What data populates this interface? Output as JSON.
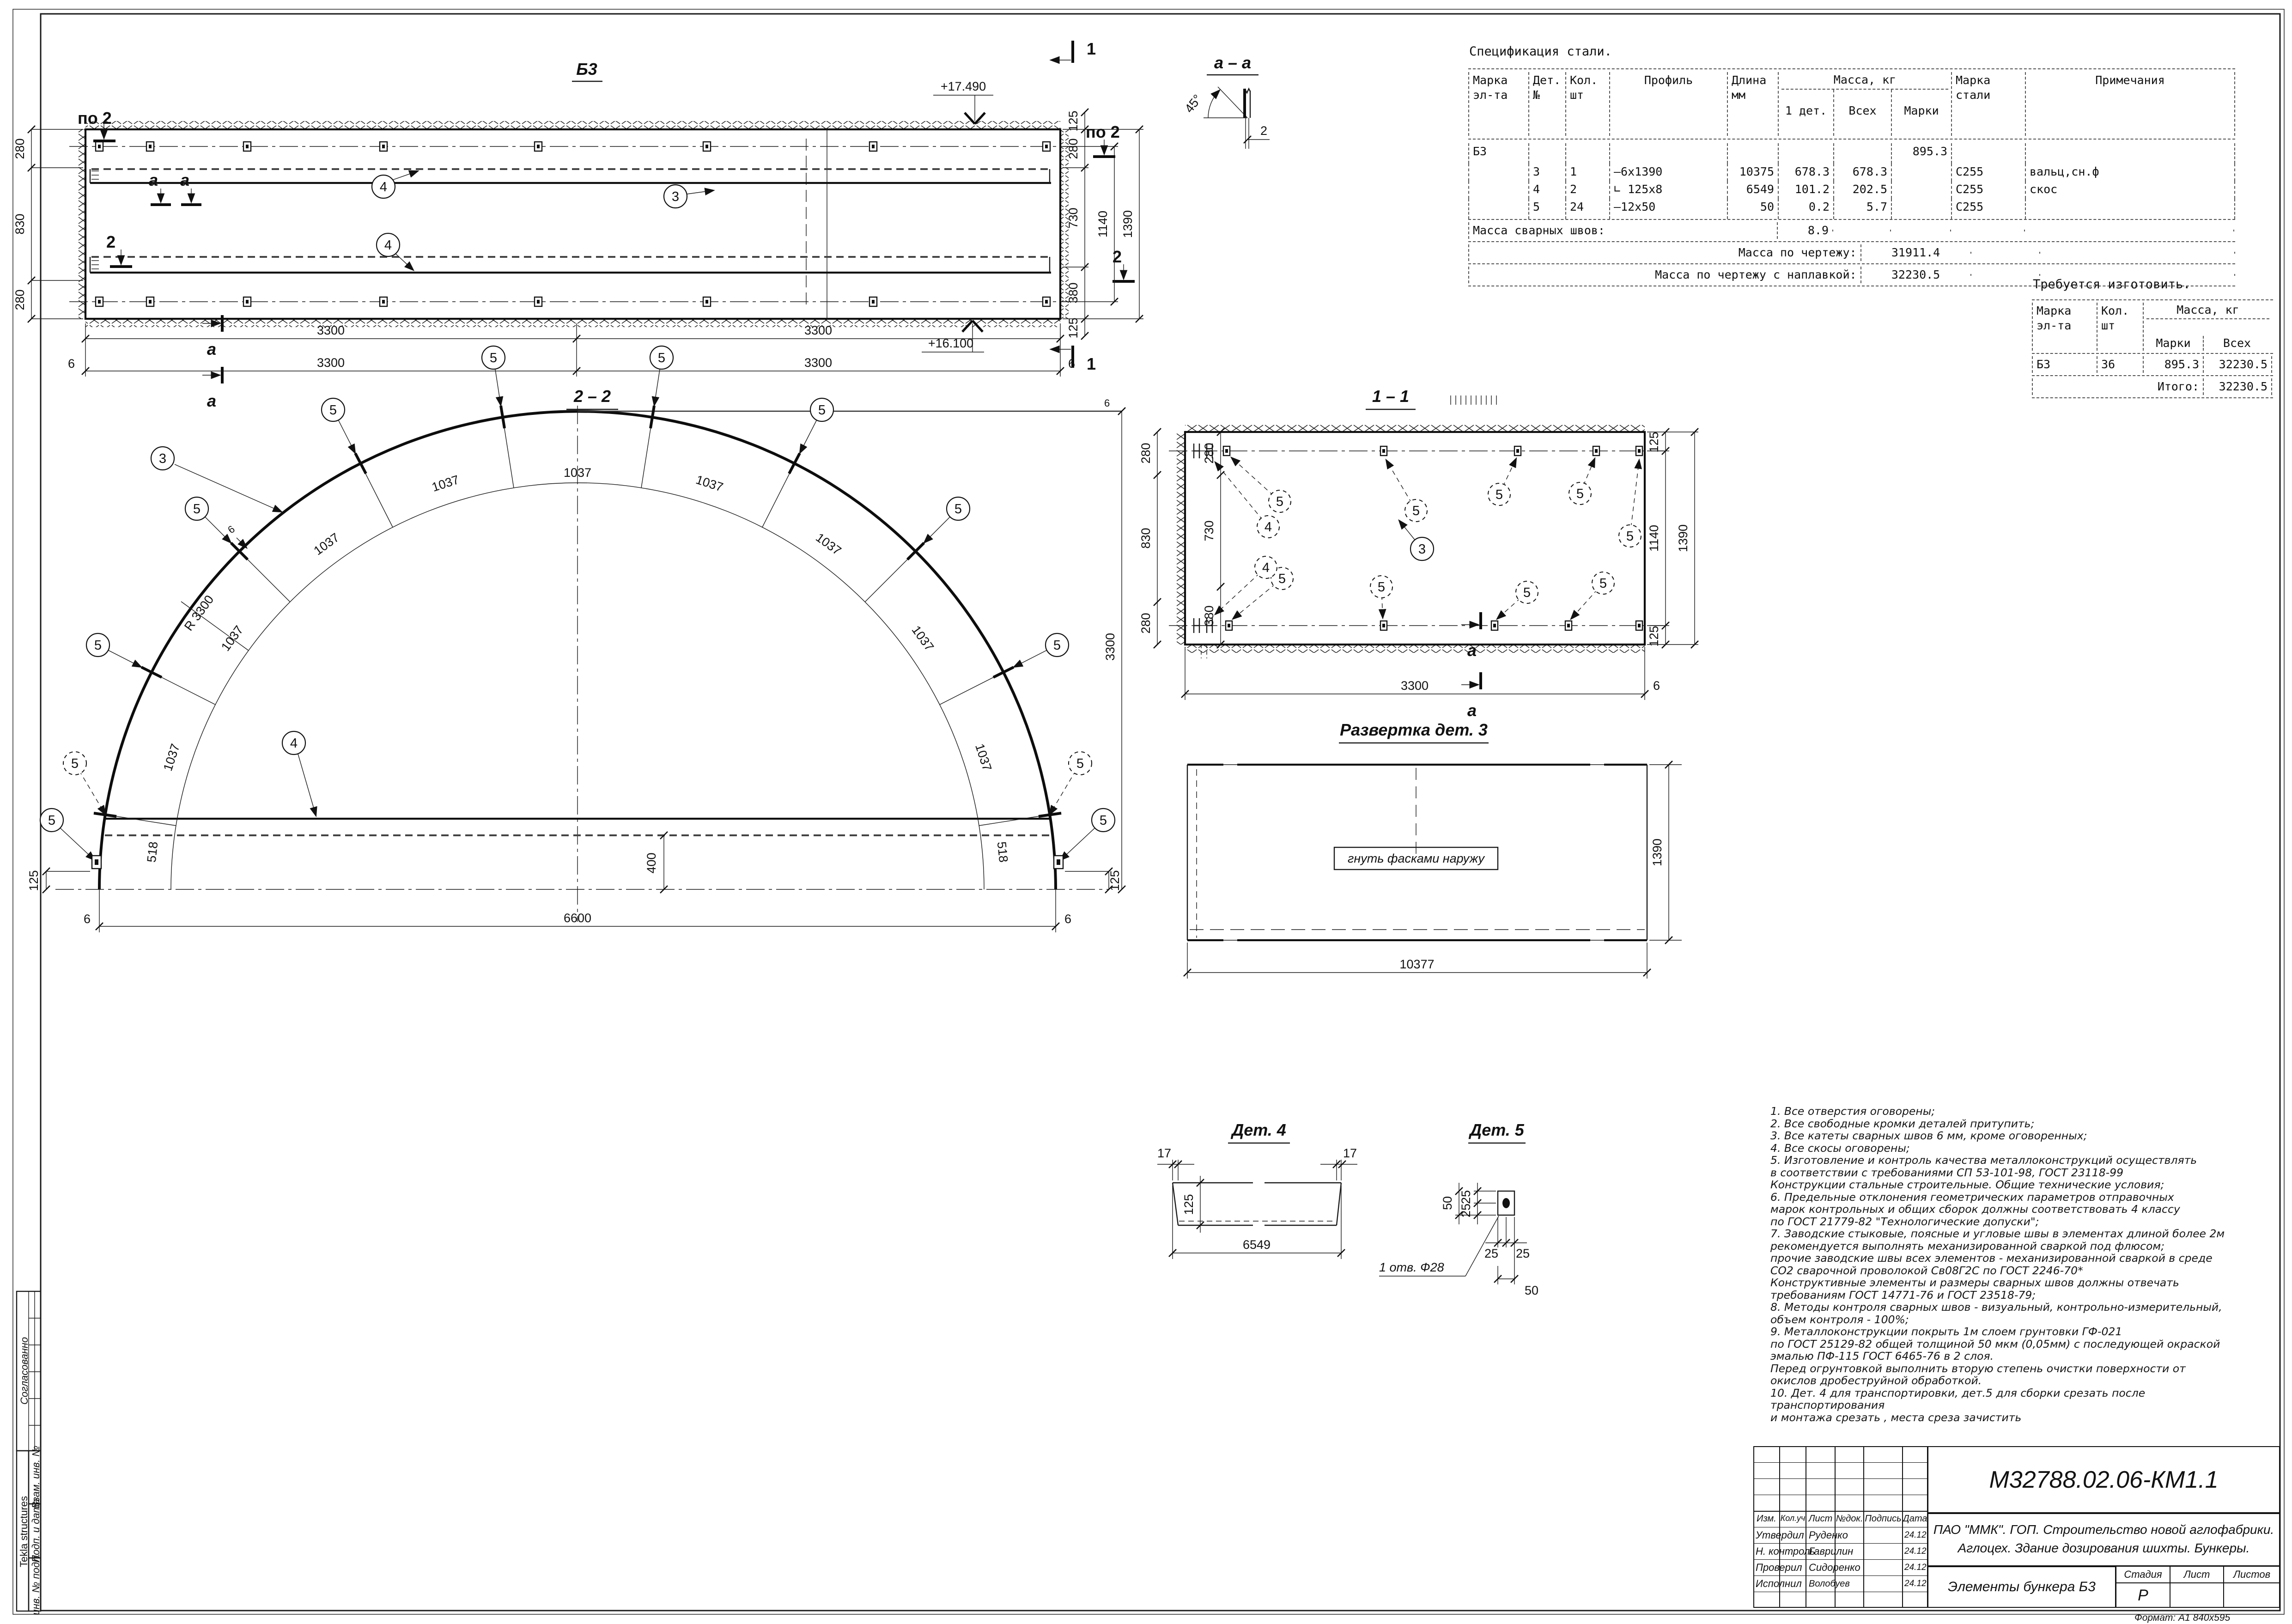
{
  "labels": {
    "b3": "Б3",
    "s22": "2 – 2",
    "s11": "1 – 1",
    "saa": "а – а",
    "razv": "Развертка дет.  3",
    "det4": "Дет. 4",
    "det5": "Дет. 5",
    "bend": "гнуть фасками наружу",
    "r3300": "R 3300",
    "seg": "1037",
    "seg2": "518",
    "d3300": "3300",
    "d6600": "6600",
    "d400": "400",
    "d125": "125",
    "d280": "280",
    "d830": "830",
    "d730": "730",
    "d380": "380",
    "d1140": "1140",
    "d1390": "1390",
    "d10377": "10377",
    "d6549": "6549",
    "d17": "17",
    "d25": "25",
    "d50": "50",
    "d6": "6",
    "d2": "2",
    "deg45": "45°",
    "elev_top": "+17.490",
    "elev_bot": "+16.100",
    "po2": "по 2",
    "m1": "1",
    "m2": "2",
    "ma": "а",
    "c3": "3",
    "c4": "4",
    "c5": "5",
    "hole": "1 отв. Ф28"
  },
  "spec": {
    "title": "Спецификация стали.",
    "col_mark": "Марка",
    "col_mark2": "эл-та",
    "col_det": "Дет.",
    "col_det2": "№",
    "col_qty": "Кол.",
    "col_qty2": "шт",
    "col_profile": "Профиль",
    "col_len": "Длина",
    "col_len2": "мм",
    "col_mass": "Масса, кг",
    "col_m1": "1 дет.",
    "col_mall": "Всех",
    "col_mmark": "Марки",
    "col_steel": "Марка",
    "col_steel2": "стали",
    "col_note": "Примечания",
    "rows": [
      {
        "mark": "Б3",
        "det": "",
        "qty": "",
        "profile": "",
        "len": "",
        "m1": "",
        "mall": "",
        "mmark": "895.3",
        "steel": "",
        "note": ""
      },
      {
        "mark": "",
        "det": "3",
        "qty": "1",
        "profile": "–6х1390",
        "len": "10375",
        "m1": "678.3",
        "mall": "678.3",
        "mmark": "",
        "steel": "С255",
        "note": "вальц,сн.ф"
      },
      {
        "mark": "",
        "det": "4",
        "qty": "2",
        "profile": "∟ 125х8",
        "len": "6549",
        "m1": "101.2",
        "mall": "202.5",
        "mmark": "",
        "steel": "С255",
        "note": "скос"
      },
      {
        "mark": "",
        "det": "5",
        "qty": "24",
        "profile": "–12х50",
        "len": "50",
        "m1": "0.2",
        "mall": "5.7",
        "mmark": "",
        "steel": "С255",
        "note": ""
      }
    ],
    "welds_label": "Масса сварных швов:",
    "welds_value": "8.9",
    "total1_label": "Масса по чертежу:",
    "total1_value": "31911.4",
    "total2_label": "Масса по чертежу с наплавкой:",
    "total2_value": "32230.5"
  },
  "require": {
    "title": "Требуется изготовить.",
    "col_mark": "Марка",
    "col_mark2": "эл-та",
    "col_qty": "Кол.",
    "col_qty2": "шт",
    "col_mass": "Масса, кг",
    "col_mmark": "Марки",
    "col_mall": "Всех",
    "row_mark": "Б3",
    "row_qty": "36",
    "row_mmark": "895.3",
    "row_mall": "32230.5",
    "total_label": "Итого:",
    "total_value": "32230.5"
  },
  "notes": "1. Все отверстия оговорены;\n2. Все свободные кромки деталей притупить;\n3. Все катеты сварных швов 6 мм, кроме оговоренных;\n4. Все скосы оговорены;\n5. Изготовление и контроль качества металлоконструкций осуществлять\nв соответствии с требованиями СП 53-101-98, ГОСТ 23118-99\nКонструкции стальные строительные. Общие технические условия;\n6. Предельные отклонения геометрических параметров отправочных\nмарок контрольных и общих сборок должны соответствовать 4 классу\nпо ГОСТ 21779-82 \"Технологические допуски\";\n7. Заводские стыковые, поясные и угловые швы в элементах длиной более 2м\nрекомендуется выполнять механизированной сваркой под флюсом;\nпрочие заводские швы всех элементов - механизированной сваркой в среде\nСО2 сварочной проволокой Св08Г2С по ГОСТ 2246-70*\nКонструктивные элементы и размеры сварных швов должны отвечать\nтребованиям ГОСТ 14771-76 и ГОСТ 23518-79;\n8. Методы контроля сварных швов - визуальный, контрольно-измерительный,\nобъем контроля - 100%;\n9. Металлоконструкции покрыть 1м слоем грунтовки ГФ-021\nпо ГОСТ 25129-82 общей толщиной 50 мкм (0,05мм) с последующей окраской\nэмалью ПФ-115 ГОСТ 6465-76 в 2 слоя.\nПеред огрунтовкой выполнить вторую степень очистки поверхности от\nокислов дробеструйной обработкой.\n10. Дет. 4 для транспортировки, дет.5 для сборки срезать после транспортирования\n и монтажа срезать , места среза зачистить",
  "titleblock": {
    "doc": "М32788.02.06-КМ1.1",
    "project1": "ПАО \"ММК\". ГОП. Строительство новой аглофабрики.",
    "project2": "Аглоцех. Здание дозирования шихты. Бункеры.",
    "sheet_title": "Элементы бункера Б3",
    "h_izm": "Изм.",
    "h_koluch": "Кол.уч",
    "h_list": "Лист",
    "h_ndok": "№док.",
    "h_podpis": "Подпись",
    "h_data": "Дата",
    "r1_role": "Утвердил",
    "r1_name": "Руденко",
    "r1_date": "24.12",
    "r2_role": "Н. контроль",
    "r2_name": "Гаврилин",
    "r2_date": "24.12",
    "r3_role": "Проверил",
    "r3_name": "Сидоренко",
    "r3_date": "24.12",
    "r4_role": "Исполнил",
    "r4_name": "Волобуев",
    "r4_date": "24.12",
    "h_stage": "Стадия",
    "h_sheet": "Лист",
    "h_sheets": "Листов",
    "stage": "Р",
    "format": "Формат: А1  840х595"
  },
  "sidebar": {
    "agreed": "Согласованно",
    "tekla": "Tekla structures",
    "vzam": "Взам. инв. №",
    "podp": "Подп. и дата",
    "inv": "инв. № подл."
  }
}
